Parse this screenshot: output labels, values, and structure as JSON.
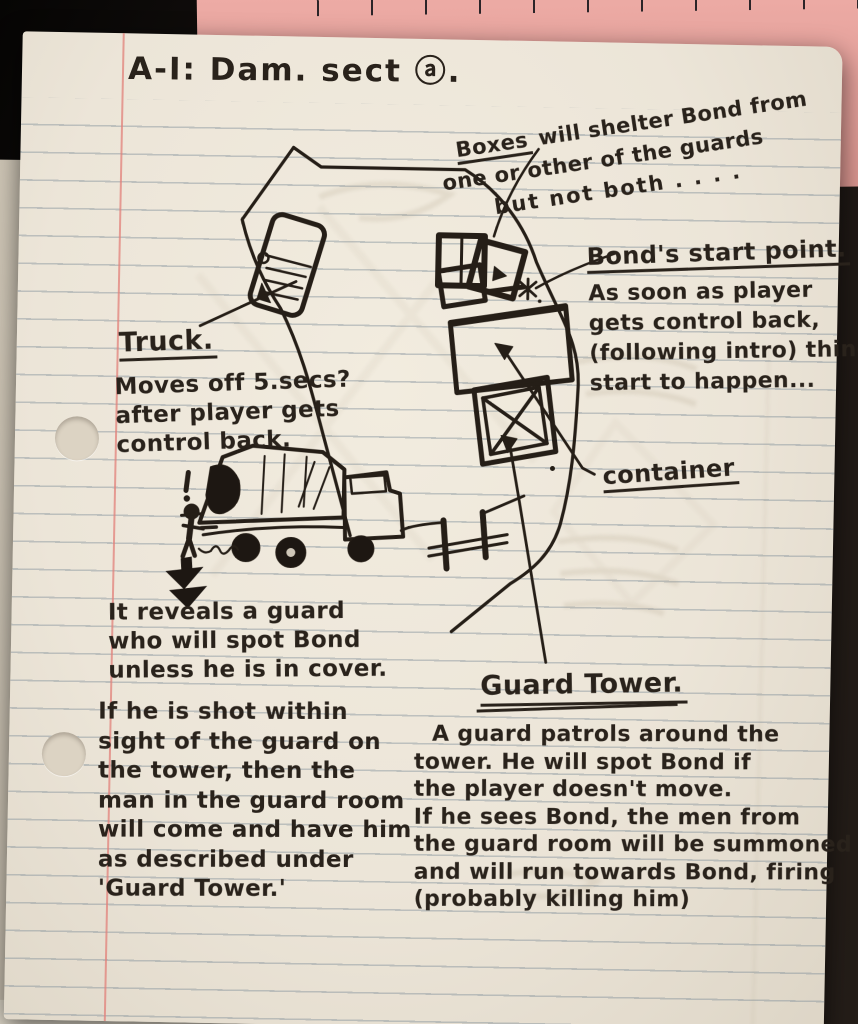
{
  "title": "A-I: Dam. sect ⓐ.",
  "notes": {
    "boxes": {
      "word": "Boxes",
      "line1_rest": " will shelter Bond from",
      "line2": "one or other of the guards",
      "line3": "but not both . . . ."
    },
    "bond_start": {
      "label": "Bond's start point.",
      "lines": [
        "As soon as player",
        "gets control back,",
        "(following intro) things",
        "start to happen..."
      ]
    },
    "truck": {
      "label": "Truck.",
      "lines": [
        "Moves off 5.secs?",
        "after player gets",
        "control back."
      ]
    },
    "container_label": "container",
    "reveal": {
      "lines": [
        "It reveals a guard",
        "who will spot Bond",
        "unless he is in cover."
      ]
    },
    "shot": {
      "lines": [
        "If he is shot within",
        "sight of the guard on",
        "the tower, then the",
        "man in the guard room",
        "will come and have him",
        "as described under",
        "'Guard Tower.'"
      ]
    },
    "guard_tower": {
      "label": "Guard Tower.",
      "lines": [
        "A guard patrols around the",
        "tower. He will spot Bond if",
        "the player doesn't move.",
        "If he sees Bond, the men from",
        "the guard room will be summoned",
        "and will run towards Bond, firing",
        "(probably killing him)"
      ]
    }
  },
  "sketch_items": {
    "road": "curved road",
    "truck_top": "truck (top view) on road",
    "boxes": "stack of boxes",
    "container": "container (top view)",
    "crate": "crossed crate / guard tower base",
    "gate": "gate / fence",
    "truck_side": "covered truck (side view)",
    "guard": "guard figure with alert mark",
    "down_arrow": "solid down arrow",
    "asterisk": "Bond start marker"
  },
  "colors": {
    "ink": "#29221b",
    "paper": "#ece5d8",
    "rule_line": "#7a8a96",
    "margin_line": "#e2807a",
    "pink_sheet": "#e8a39e",
    "backdrop": "#171210"
  }
}
